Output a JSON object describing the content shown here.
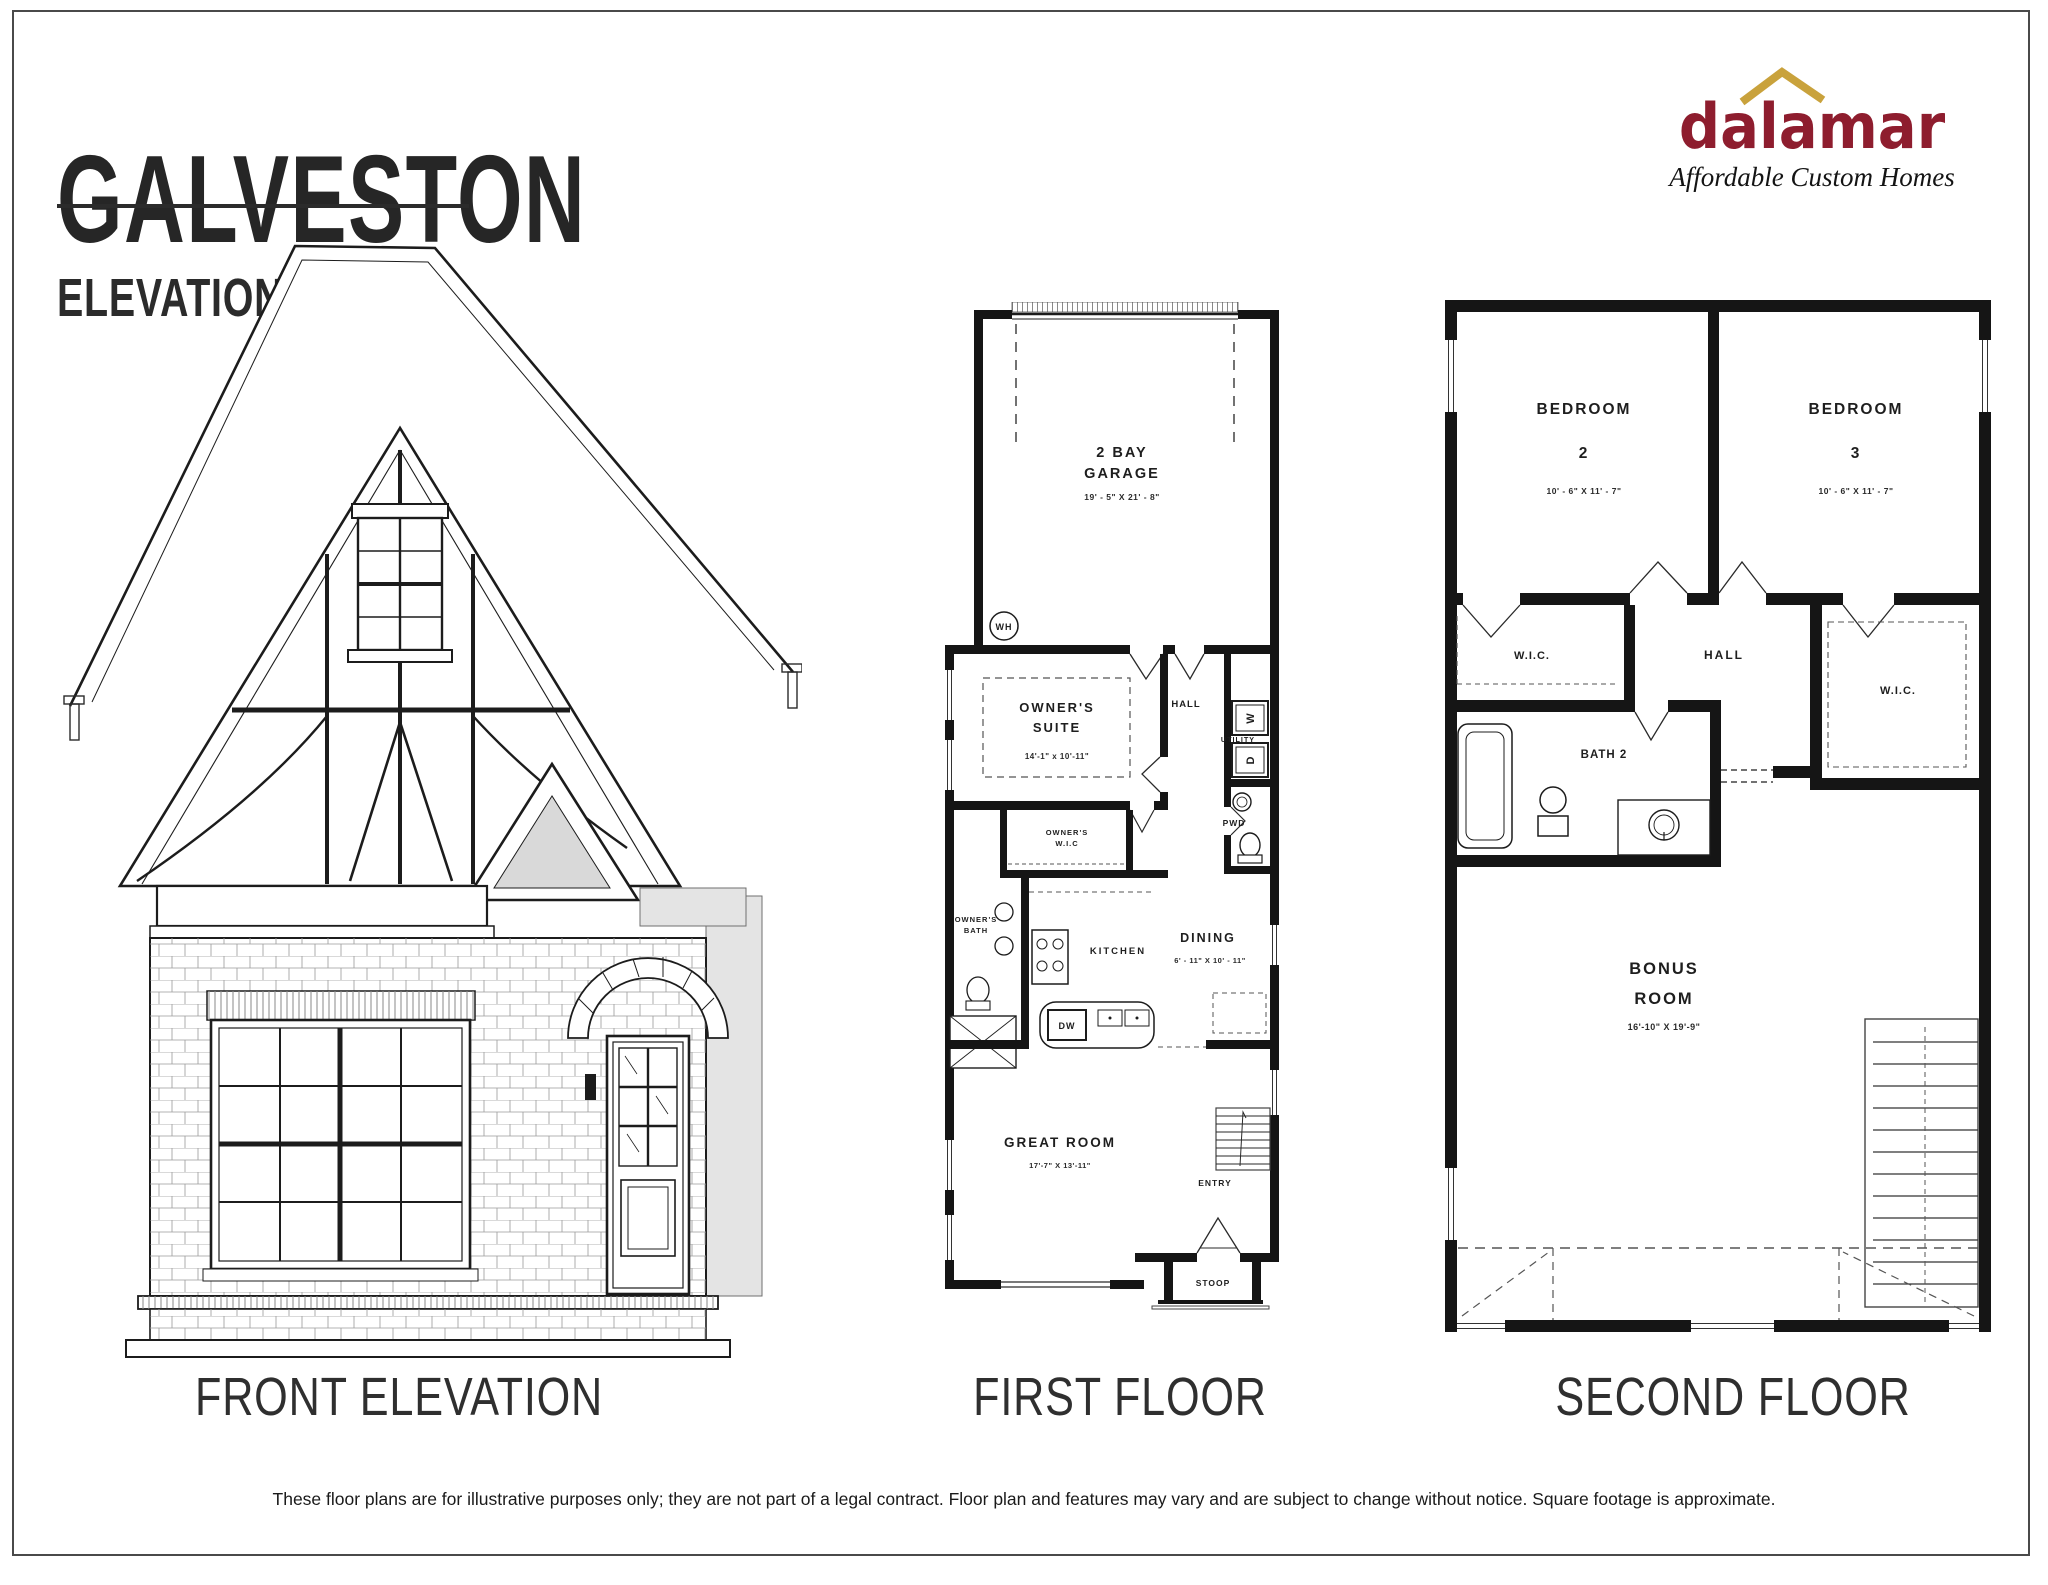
{
  "header": {
    "title": "GALVESTON",
    "subtitle": "ELEVATION B"
  },
  "logo": {
    "brand": "dalamar",
    "tagline": "Affordable Custom Homes",
    "brand_color": "#8e1d2e",
    "roof_color": "#c9a23c"
  },
  "captions": {
    "elevation": "FRONT ELEVATION",
    "first_floor": "FIRST FLOOR",
    "second_floor": "SECOND FLOOR"
  },
  "first_floor": {
    "garage": {
      "name": [
        "2 BAY",
        "GARAGE"
      ],
      "dims": "19' - 5\" X 21' - 8\""
    },
    "water_heater": "WH",
    "owners_suite": {
      "name": [
        "OWNER'S",
        "SUITE"
      ],
      "dims": "14'-1\" x 10'-11\""
    },
    "hall": "HALL",
    "utility": {
      "label": "UTILITY",
      "washer": "W",
      "dryer": "D"
    },
    "powder": "PWD",
    "owners_wic": {
      "name": [
        "OWNER'S",
        "W.I.C"
      ]
    },
    "owners_bath": {
      "name": [
        "OWNER'S",
        "BATH"
      ]
    },
    "kitchen": "KITCHEN",
    "dining": {
      "name": "DINING",
      "dims": "6' - 11\" X 10' - 11\""
    },
    "dishwasher": "DW",
    "great_room": {
      "name": "GREAT ROOM",
      "dims": "17'-7\" X 13'-11\""
    },
    "entry": "ENTRY",
    "stoop": "STOOP"
  },
  "second_floor": {
    "bedroom2": {
      "name": [
        "BEDROOM",
        "2"
      ],
      "dims": "10' - 6\" X 11' - 7\""
    },
    "bedroom3": {
      "name": [
        "BEDROOM",
        "3"
      ],
      "dims": "10' - 6\" X 11' - 7\""
    },
    "wic_left": "W.I.C.",
    "hall": "HALL",
    "wic_right": "W.I.C.",
    "bath2": "BATH 2",
    "bonus": {
      "name": [
        "BONUS",
        "ROOM"
      ],
      "dims": "16'-10\" X 19'-9\""
    }
  },
  "footer": {
    "disclaimer": "These floor plans are for illustrative purposes only; they are not part of a legal contract. Floor plan and features may vary and are subject to change without notice. Square footage is approximate."
  }
}
